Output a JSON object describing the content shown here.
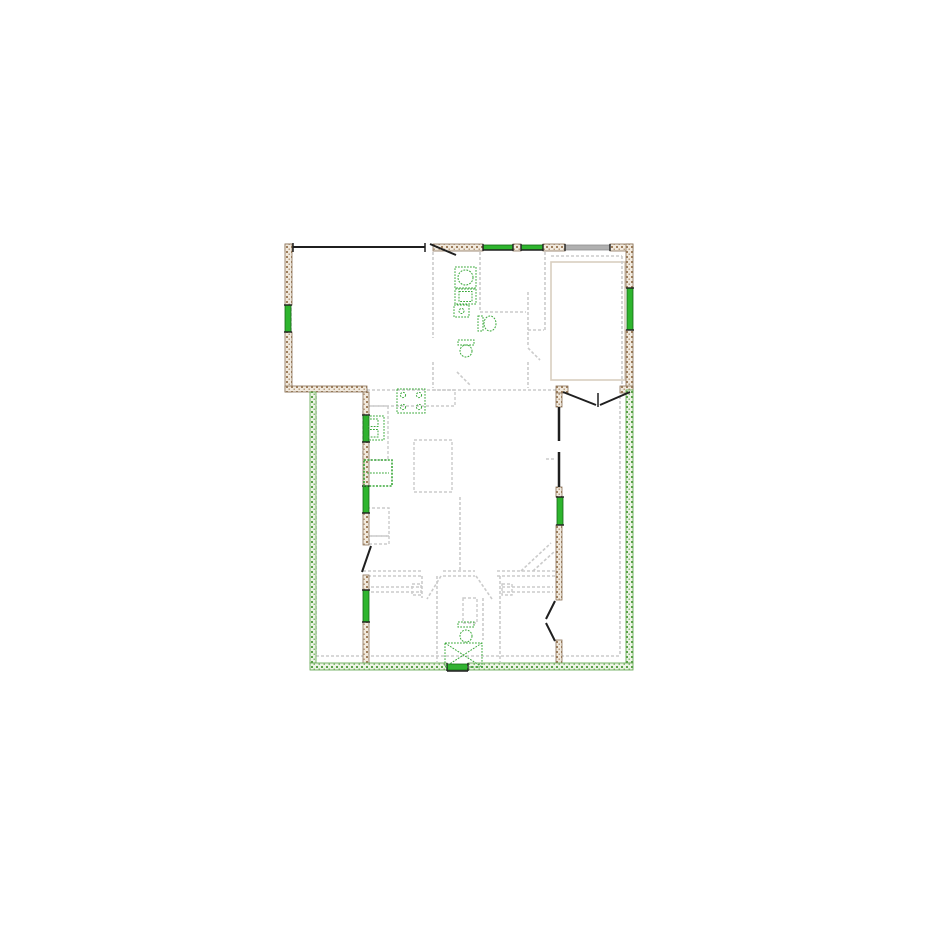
{
  "document": {
    "kind": "architectural-floor-plan",
    "background": "#ffffff",
    "canvas": {
      "width": 925,
      "height": 925
    }
  },
  "palette": {
    "wall_line": "#8a7258",
    "wall_fill": "#f1eadf",
    "wall_hatch_brown": "#a07f5c",
    "wall_fill_green": "#edf3e6",
    "wall_hatch_green": "#5aa348",
    "window_green": "#2eb52e",
    "window_green_dark": "#156615",
    "window_gray": "#b0b0b0",
    "window_gray_dark": "#8f8f8f",
    "door_black": "#1f1f1f",
    "interior_gray": "#cbcbcb",
    "fixture_green": "#3aa83a",
    "slab_tan": "#d8cec0"
  },
  "hatched_walls": [
    {
      "name": "wall-top-corner-left",
      "hatch": "brown",
      "x": 285,
      "y": 244,
      "w": 8,
      "h": 7
    },
    {
      "name": "wall-top-mid",
      "hatch": "brown",
      "x": 433,
      "y": 244,
      "w": 50,
      "h": 7
    },
    {
      "name": "wall-top-between-windows",
      "hatch": "brown",
      "x": 513,
      "y": 244,
      "w": 8,
      "h": 7
    },
    {
      "name": "wall-top-right-a",
      "hatch": "brown",
      "x": 543,
      "y": 244,
      "w": 22,
      "h": 7
    },
    {
      "name": "wall-top-right-b",
      "hatch": "brown",
      "x": 610,
      "y": 244,
      "w": 23,
      "h": 7
    },
    {
      "name": "wall-left-upper-a",
      "hatch": "brown",
      "x": 285,
      "y": 244,
      "w": 7,
      "h": 61
    },
    {
      "name": "wall-left-upper-b",
      "hatch": "brown",
      "x": 285,
      "y": 332,
      "w": 7,
      "h": 60
    },
    {
      "name": "wall-right-upper-a",
      "hatch": "brown",
      "x": 626,
      "y": 244,
      "w": 7,
      "h": 44
    },
    {
      "name": "wall-right-upper-b",
      "hatch": "brown",
      "x": 626,
      "y": 330,
      "w": 7,
      "h": 60
    },
    {
      "name": "wall-garage-south",
      "hatch": "brown",
      "x": 285,
      "y": 386,
      "w": 82,
      "h": 6
    },
    {
      "name": "wall-inner-left-a",
      "hatch": "brown",
      "x": 363,
      "y": 392,
      "w": 6,
      "h": 23
    },
    {
      "name": "wall-inner-left-b",
      "hatch": "brown",
      "x": 363,
      "y": 442,
      "w": 6,
      "h": 44
    },
    {
      "name": "wall-inner-left-c",
      "hatch": "brown",
      "x": 363,
      "y": 513,
      "w": 6,
      "h": 32
    },
    {
      "name": "wall-inner-left-d",
      "hatch": "brown",
      "x": 363,
      "y": 575,
      "w": 6,
      "h": 15
    },
    {
      "name": "wall-inner-left-e",
      "hatch": "brown",
      "x": 363,
      "y": 622,
      "w": 6,
      "h": 46
    },
    {
      "name": "wall-frenchdoor-stub-left",
      "hatch": "brown",
      "x": 556,
      "y": 386,
      "w": 12,
      "h": 7
    },
    {
      "name": "wall-frenchdoor-stub-right",
      "hatch": "brown",
      "x": 620,
      "y": 386,
      "w": 13,
      "h": 7
    },
    {
      "name": "wall-inner-right-a",
      "hatch": "brown",
      "x": 556,
      "y": 393,
      "w": 6,
      "h": 14
    },
    {
      "name": "wall-inner-right-b",
      "hatch": "brown",
      "x": 556,
      "y": 487,
      "w": 6,
      "h": 10
    },
    {
      "name": "wall-inner-right-c",
      "hatch": "brown",
      "x": 556,
      "y": 525,
      "w": 6,
      "h": 75
    },
    {
      "name": "wall-inner-right-d",
      "hatch": "brown",
      "x": 556,
      "y": 640,
      "w": 6,
      "h": 28
    },
    {
      "name": "wall-left-lower",
      "hatch": "green",
      "x": 310,
      "y": 392,
      "w": 6,
      "h": 271
    },
    {
      "name": "wall-right-lower",
      "hatch": "green",
      "x": 626,
      "y": 390,
      "w": 7,
      "h": 273
    },
    {
      "name": "wall-bottom-a",
      "hatch": "green",
      "x": 310,
      "y": 663,
      "w": 137,
      "h": 7
    },
    {
      "name": "wall-bottom-b",
      "hatch": "green",
      "x": 468,
      "y": 663,
      "w": 165,
      "h": 7
    }
  ],
  "windows": [
    {
      "name": "window-top-1",
      "color": "green",
      "x": 483,
      "y": 245,
      "w": 30,
      "h": 5
    },
    {
      "name": "window-top-2",
      "color": "green",
      "x": 521,
      "y": 245,
      "w": 22,
      "h": 5
    },
    {
      "name": "window-top-gray",
      "color": "gray",
      "x": 565,
      "y": 245,
      "w": 45,
      "h": 5
    },
    {
      "name": "window-left-garage",
      "color": "green",
      "x": 285,
      "y": 305,
      "w": 6,
      "h": 27
    },
    {
      "name": "window-right-upper",
      "color": "green",
      "x": 627,
      "y": 288,
      "w": 6,
      "h": 42
    },
    {
      "name": "window-kitchen-sink",
      "color": "green",
      "x": 363,
      "y": 415,
      "w": 6,
      "h": 27
    },
    {
      "name": "window-kitchen-2",
      "color": "green",
      "x": 363,
      "y": 486,
      "w": 6,
      "h": 27
    },
    {
      "name": "window-bedroom-left",
      "color": "green",
      "x": 363,
      "y": 590,
      "w": 6,
      "h": 32
    },
    {
      "name": "window-right-mid",
      "color": "green",
      "x": 557,
      "y": 497,
      "w": 6,
      "h": 28
    },
    {
      "name": "vent-bottom",
      "color": "green",
      "x": 447,
      "y": 664,
      "w": 21,
      "h": 6
    }
  ],
  "black_lines": [
    {
      "name": "garage-opening-header",
      "x1": 293,
      "y1": 247,
      "x2": 425,
      "y2": 247,
      "w": 2
    },
    {
      "name": "garage-opening-tick-left",
      "x1": 293,
      "y1": 243,
      "x2": 293,
      "y2": 252,
      "w": 1.5
    },
    {
      "name": "garage-opening-tick-right",
      "x1": 425,
      "y1": 243,
      "x2": 425,
      "y2": 252,
      "w": 1.5
    },
    {
      "name": "man-door-leaf",
      "x1": 430,
      "y1": 244,
      "x2": 456,
      "y2": 255,
      "w": 2
    },
    {
      "name": "window-sash-1",
      "x1": 483,
      "y1": 250,
      "x2": 513,
      "y2": 250,
      "w": 1.4
    },
    {
      "name": "window-sash-2",
      "x1": 521,
      "y1": 250,
      "x2": 543,
      "y2": 250,
      "w": 1.4
    },
    {
      "name": "french-door-leaf-left",
      "x1": 563,
      "y1": 392,
      "x2": 596,
      "y2": 405,
      "w": 2
    },
    {
      "name": "french-door-leaf-right",
      "x1": 630,
      "y1": 392,
      "x2": 600,
      "y2": 405,
      "w": 2
    },
    {
      "name": "french-door-tick",
      "x1": 598,
      "y1": 393,
      "x2": 598,
      "y2": 407,
      "w": 1.5
    },
    {
      "name": "kitchen-door-leaf",
      "x1": 371,
      "y1": 546,
      "x2": 362,
      "y2": 572,
      "w": 2
    },
    {
      "name": "wall-black-right-a",
      "x1": 559,
      "y1": 407,
      "x2": 559,
      "y2": 441,
      "w": 2.5
    },
    {
      "name": "wall-black-right-b",
      "x1": 559,
      "y1": 452,
      "x2": 559,
      "y2": 487,
      "w": 2.5
    },
    {
      "name": "double-door-leaf-top",
      "x1": 555,
      "y1": 601,
      "x2": 546,
      "y2": 619,
      "w": 2
    },
    {
      "name": "double-door-leaf-bottom",
      "x1": 555,
      "y1": 641,
      "x2": 546,
      "y2": 623,
      "w": 2
    },
    {
      "name": "vent-bottom-line",
      "x1": 447,
      "y1": 671,
      "x2": 468,
      "y2": 671,
      "w": 1.5
    }
  ],
  "interior_lines": [
    {
      "name": "iw-laundry-west-a",
      "x1": 433,
      "y1": 252,
      "x2": 433,
      "y2": 338
    },
    {
      "name": "iw-laundry-west-b",
      "x1": 433,
      "y1": 362,
      "x2": 433,
      "y2": 388
    },
    {
      "name": "iw-bath-west",
      "x1": 480,
      "y1": 252,
      "x2": 480,
      "y2": 310
    },
    {
      "name": "iw-bath-south",
      "x1": 480,
      "y1": 312,
      "x2": 526,
      "y2": 312
    },
    {
      "name": "iw-hall-east-a",
      "x1": 528,
      "y1": 292,
      "x2": 528,
      "y2": 346
    },
    {
      "name": "iw-hall-east-b",
      "x1": 528,
      "y1": 362,
      "x2": 528,
      "y2": 388
    },
    {
      "name": "iw-closet-shelf-top",
      "x1": 528,
      "y1": 330,
      "x2": 544,
      "y2": 330
    },
    {
      "name": "iw-room-tr-west",
      "x1": 545,
      "y1": 252,
      "x2": 545,
      "y2": 330
    },
    {
      "name": "iw-living-north",
      "x1": 433,
      "y1": 390,
      "x2": 556,
      "y2": 390
    },
    {
      "name": "iw-hall-west",
      "x1": 460,
      "y1": 497,
      "x2": 460,
      "y2": 571
    },
    {
      "name": "iw-bed-north-a1",
      "x1": 363,
      "y1": 571,
      "x2": 422,
      "y2": 571
    },
    {
      "name": "iw-bed-north-a2",
      "x1": 443,
      "y1": 571,
      "x2": 475,
      "y2": 571
    },
    {
      "name": "iw-bed-north-a3",
      "x1": 497,
      "y1": 571,
      "x2": 556,
      "y2": 571
    },
    {
      "name": "iw-bed-north-b1",
      "x1": 363,
      "y1": 576,
      "x2": 422,
      "y2": 576
    },
    {
      "name": "iw-bed-north-b2",
      "x1": 443,
      "y1": 576,
      "x2": 475,
      "y2": 576
    },
    {
      "name": "iw-bed-north-b3",
      "x1": 497,
      "y1": 576,
      "x2": 556,
      "y2": 576
    },
    {
      "name": "iw-bath2-west",
      "x1": 437,
      "y1": 576,
      "x2": 437,
      "y2": 662
    },
    {
      "name": "iw-bath2-east",
      "x1": 500,
      "y1": 576,
      "x2": 500,
      "y2": 662
    },
    {
      "name": "iw-shower-east",
      "x1": 483,
      "y1": 598,
      "x2": 483,
      "y2": 640
    },
    {
      "name": "iw-closet-wall",
      "x1": 422,
      "y1": 576,
      "x2": 422,
      "y2": 598
    },
    {
      "name": "closet-shelf-l1",
      "x1": 366,
      "y1": 587,
      "x2": 420,
      "y2": 587
    },
    {
      "name": "closet-shelf-l2",
      "x1": 366,
      "y1": 592,
      "x2": 420,
      "y2": 592
    },
    {
      "name": "closet-shelf-r1",
      "x1": 502,
      "y1": 587,
      "x2": 553,
      "y2": 587
    },
    {
      "name": "closet-shelf-r2",
      "x1": 502,
      "y1": 592,
      "x2": 553,
      "y2": 592
    },
    {
      "name": "door-leaf-bed1",
      "x1": 441,
      "y1": 576,
      "x2": 427,
      "y2": 599
    },
    {
      "name": "door-leaf-bed2",
      "x1": 476,
      "y1": 576,
      "x2": 492,
      "y2": 599
    },
    {
      "name": "door-leaf-hall",
      "x1": 528,
      "y1": 348,
      "x2": 540,
      "y2": 360
    },
    {
      "name": "door-leaf-laundry",
      "x1": 457,
      "y1": 372,
      "x2": 471,
      "y2": 386
    },
    {
      "name": "porch-left-inner",
      "x1": 316,
      "y1": 396,
      "x2": 316,
      "y2": 656
    },
    {
      "name": "porch-bottom-inner",
      "x1": 316,
      "y1": 656,
      "x2": 620,
      "y2": 656
    },
    {
      "name": "porch-right-inner",
      "x1": 620,
      "y1": 396,
      "x2": 620,
      "y2": 656
    },
    {
      "name": "garage-inner-west",
      "x1": 291,
      "y1": 253,
      "x2": 291,
      "y2": 382
    },
    {
      "name": "room-tr-inner-north",
      "x1": 551,
      "y1": 256,
      "x2": 622,
      "y2": 256
    },
    {
      "name": "room-tr-inner-east",
      "x1": 622,
      "y1": 256,
      "x2": 622,
      "y2": 384
    },
    {
      "name": "dim-tick",
      "x1": 546,
      "y1": 459,
      "x2": 556,
      "y2": 459
    },
    {
      "name": "roof-diag-1",
      "x1": 521,
      "y1": 571,
      "x2": 551,
      "y2": 543
    },
    {
      "name": "roof-diag-2",
      "x1": 533,
      "y1": 571,
      "x2": 555,
      "y2": 551
    }
  ],
  "interior_rects": [
    {
      "name": "kitchen-counter-top",
      "x": 367,
      "y": 390,
      "w": 88,
      "h": 16,
      "style": "dashed"
    },
    {
      "name": "kitchen-counter-left",
      "x": 363,
      "y": 406,
      "w": 25,
      "h": 54,
      "style": "dashed"
    },
    {
      "name": "kitchen-island",
      "x": 414,
      "y": 440,
      "w": 38,
      "h": 52,
      "style": "dashed"
    },
    {
      "name": "cabinet-a",
      "x": 367,
      "y": 508,
      "w": 22,
      "h": 28,
      "style": "dashed"
    },
    {
      "name": "cabinet-b",
      "x": 369,
      "y": 536,
      "w": 20,
      "h": 8,
      "style": "dashed"
    },
    {
      "name": "bath-vanity",
      "x": 463,
      "y": 598,
      "w": 14,
      "h": 25,
      "style": "dashed"
    },
    {
      "name": "closet-box-left",
      "x": 412,
      "y": 584,
      "w": 9,
      "h": 11,
      "style": "dashed"
    },
    {
      "name": "closet-box-right",
      "x": 502,
      "y": 584,
      "w": 10,
      "h": 11,
      "style": "dashed"
    },
    {
      "name": "garage-slab",
      "x": 551,
      "y": 262,
      "w": 74,
      "h": 118,
      "style": "slab"
    }
  ],
  "fixtures": [
    {
      "name": "washer",
      "kind": "washer",
      "x": 455,
      "y": 267,
      "w": 21,
      "h": 21
    },
    {
      "name": "dryer",
      "kind": "dryer",
      "x": 455,
      "y": 289,
      "w": 21,
      "h": 15
    },
    {
      "name": "laundry-sink",
      "kind": "small-sink",
      "x": 454,
      "y": 305,
      "w": 15,
      "h": 12
    },
    {
      "name": "toilet-hall",
      "kind": "toilet-right",
      "x": 478,
      "y": 314,
      "w": 19,
      "h": 19
    },
    {
      "name": "toilet-mid",
      "kind": "toilet-down",
      "x": 456,
      "y": 340,
      "w": 20,
      "h": 17
    },
    {
      "name": "kitchen-range",
      "kind": "range",
      "x": 397,
      "y": 389,
      "w": 28,
      "h": 24
    },
    {
      "name": "kitchen-sink",
      "kind": "sink2",
      "x": 364,
      "y": 416,
      "w": 20,
      "h": 24
    },
    {
      "name": "refrigerator",
      "kind": "fridge",
      "x": 364,
      "y": 460,
      "w": 28,
      "h": 26
    },
    {
      "name": "toilet-bath",
      "kind": "toilet-down",
      "x": 456,
      "y": 622,
      "w": 20,
      "h": 20
    },
    {
      "name": "shower",
      "kind": "shower-x",
      "x": 445,
      "y": 643,
      "w": 37,
      "h": 24
    }
  ]
}
